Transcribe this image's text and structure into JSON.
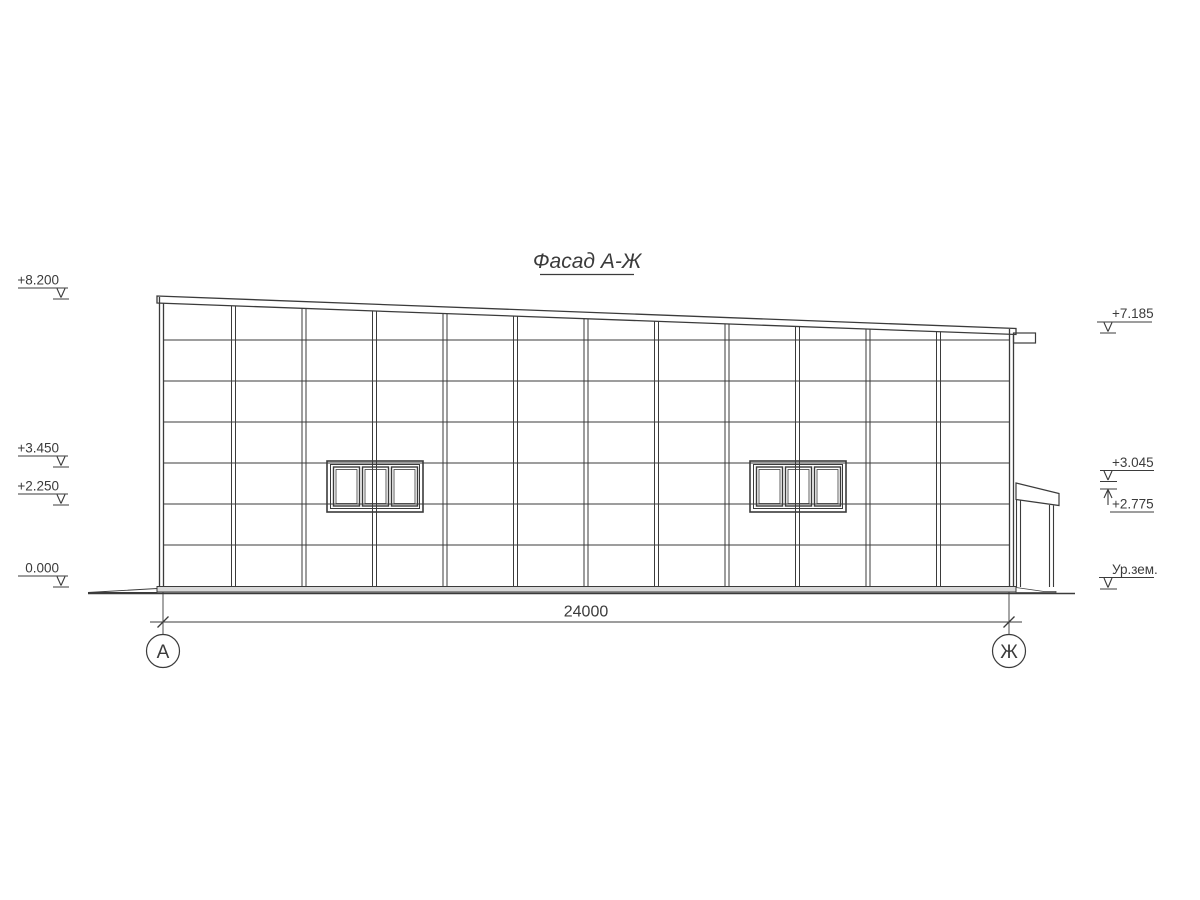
{
  "title": "Фасад А-Ж",
  "drawing": {
    "dimension_total": "24000",
    "axis_left": "А",
    "axis_right": "Ж"
  },
  "marks": {
    "left": [
      {
        "label": "+8.200"
      },
      {
        "label": "+3.450"
      },
      {
        "label": "+2.250"
      },
      {
        "label": "0.000"
      }
    ],
    "right": [
      {
        "label": "+7.185"
      },
      {
        "label": "+3.045"
      },
      {
        "label": "+2.775"
      },
      {
        "label": "Ур.зем."
      }
    ]
  },
  "colors": {
    "line": "#3b3b3b",
    "plinth_fill": "#d9d9d9",
    "background": "#ffffff"
  }
}
